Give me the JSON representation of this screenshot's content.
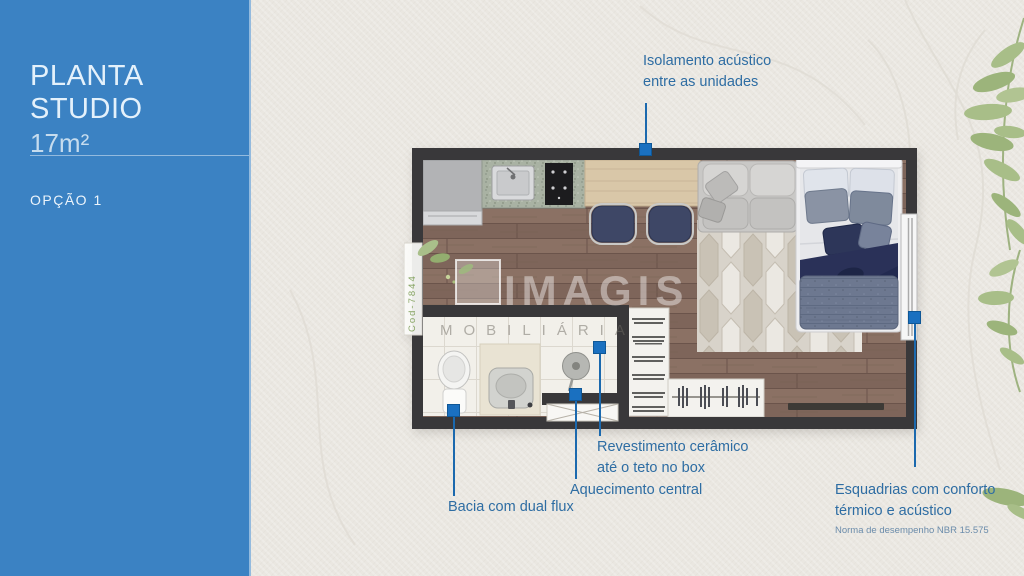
{
  "sidebar": {
    "title": "PLANTA STUDIO",
    "area": "17m²",
    "option": "OPÇÃO 1"
  },
  "annotations": {
    "isolamento": {
      "line1": "Isolamento acústico",
      "line2": "entre as unidades"
    },
    "bacia": {
      "line1": "Bacia com dual flux"
    },
    "aquecimento": {
      "line1": "Aquecimento central"
    },
    "revestimento": {
      "line1": "Revestimento cerâmico",
      "line2": "até o teto no box"
    },
    "esquadrias": {
      "line1": "Esquadrias com conforto",
      "line2": "térmico e acústico",
      "note": "Norma de desempenho NBR 15.575"
    }
  },
  "watermark": {
    "brand": "IMAGIS",
    "subtitle": "MOBILIÁRIA",
    "code": "Cod-7844"
  },
  "colors": {
    "sidebar_bg": "#3b82c3",
    "paper": "#eae7e1",
    "annotation_text": "#2e6da3",
    "pointer_line": "#1b69ae",
    "marker": "#1a70c0",
    "wall": "#39383a",
    "leaf_green": "#a8be88"
  }
}
